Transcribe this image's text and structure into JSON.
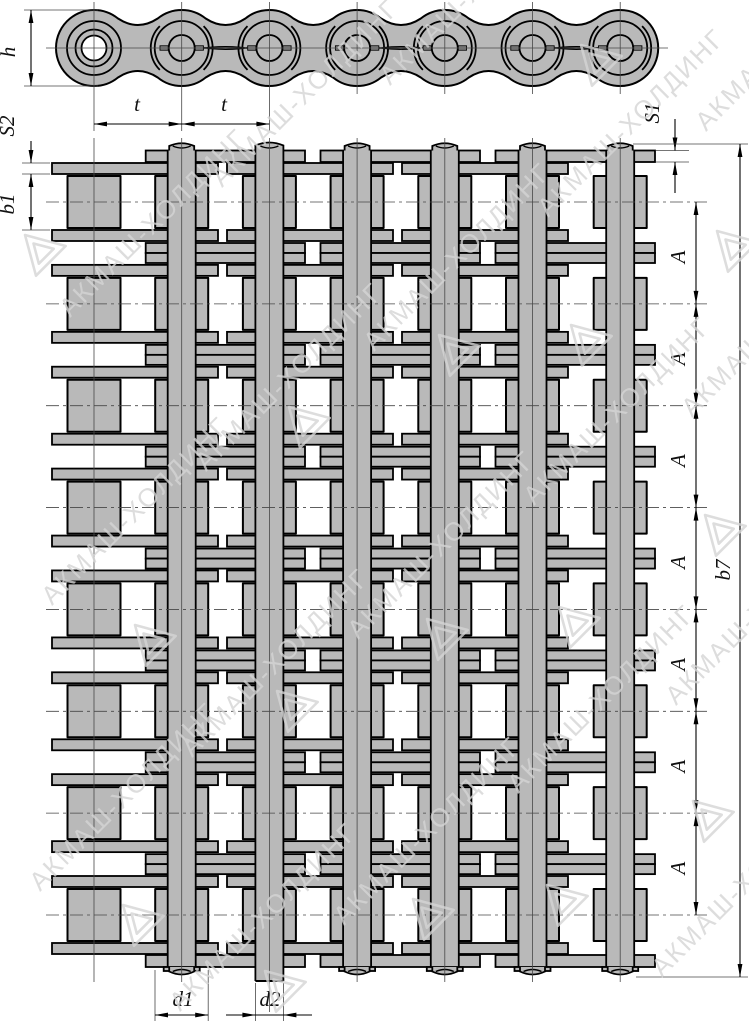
{
  "watermark": {
    "text": "АКМАШ-ХОЛДИНГ"
  },
  "dimensions": {
    "h": "h",
    "t": "t",
    "S2": "S2",
    "b1": "b1",
    "S1": "S1",
    "A": "A",
    "b7": "b7",
    "d1": "d1",
    "d2": "d2"
  },
  "colors": {
    "chain_fill": "#b9b9b9",
    "line": "#000000",
    "watermark": "#d5d5d5"
  }
}
